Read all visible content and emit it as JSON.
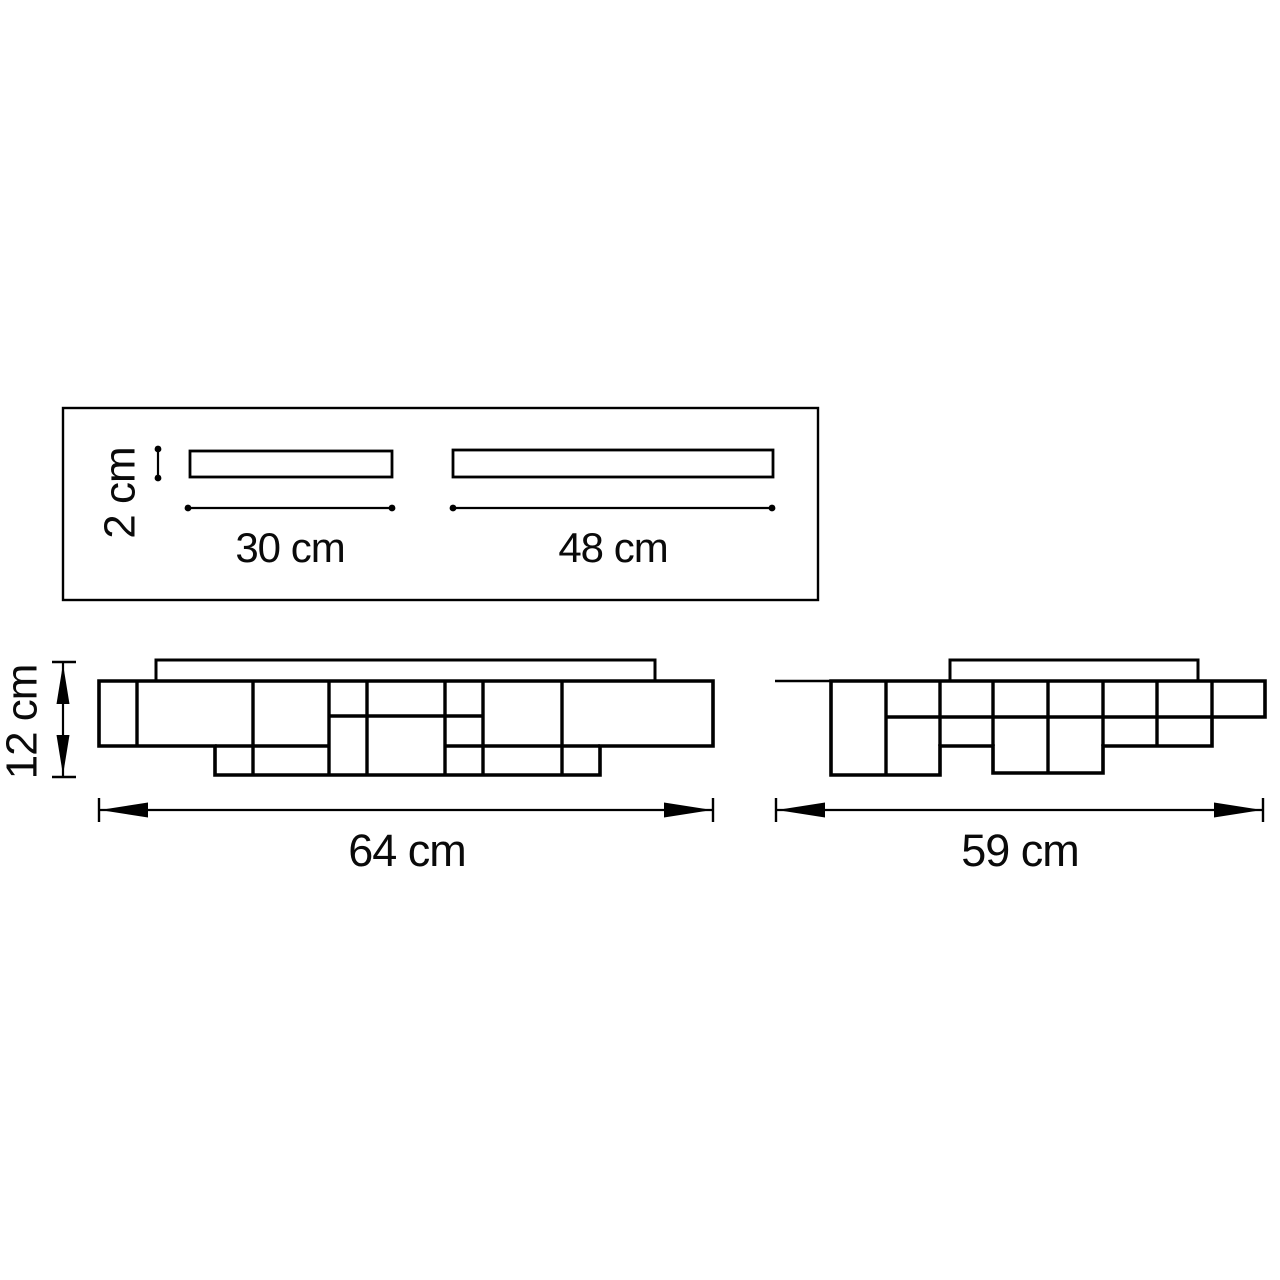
{
  "colors": {
    "ink": "#000000",
    "background": "#ffffff"
  },
  "top_view": {
    "thickness_label": "2 cm",
    "tube_small_label": "30 cm",
    "tube_large_label": "48 cm"
  },
  "front_view": {
    "height_label": "12 cm",
    "width_label": "64 cm"
  },
  "side_view": {
    "width_label": "59 cm"
  }
}
